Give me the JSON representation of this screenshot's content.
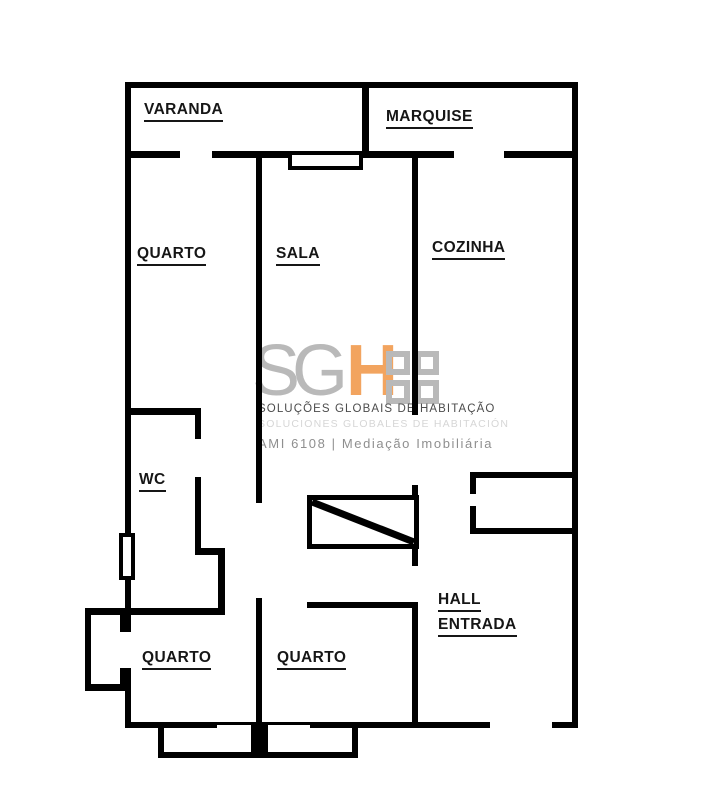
{
  "rooms": {
    "varanda": "VARANDA",
    "marquise": "MARQUISE",
    "quarto_top": "QUARTO",
    "sala": "SALA",
    "cozinha": "COZINHA",
    "wc": "WC",
    "hall_line1": "HALL",
    "hall_line2": "ENTRADA",
    "quarto_bottom_left": "QUARTO",
    "quarto_bottom_middle": "QUARTO"
  },
  "watermark": {
    "logo_text_gray": "SG",
    "logo_text_accent": "H",
    "tagline": "SOLUÇÕES GLOBAIS DE HABITAÇÃO",
    "tagline_shadow": "SOLUCIONES GLOBALES DE HABITACIÓN",
    "license": "AMI 6108 | Mediação Imobiliária",
    "accent_color": "#F2A45F",
    "gray_color": "#B9B9B9"
  }
}
